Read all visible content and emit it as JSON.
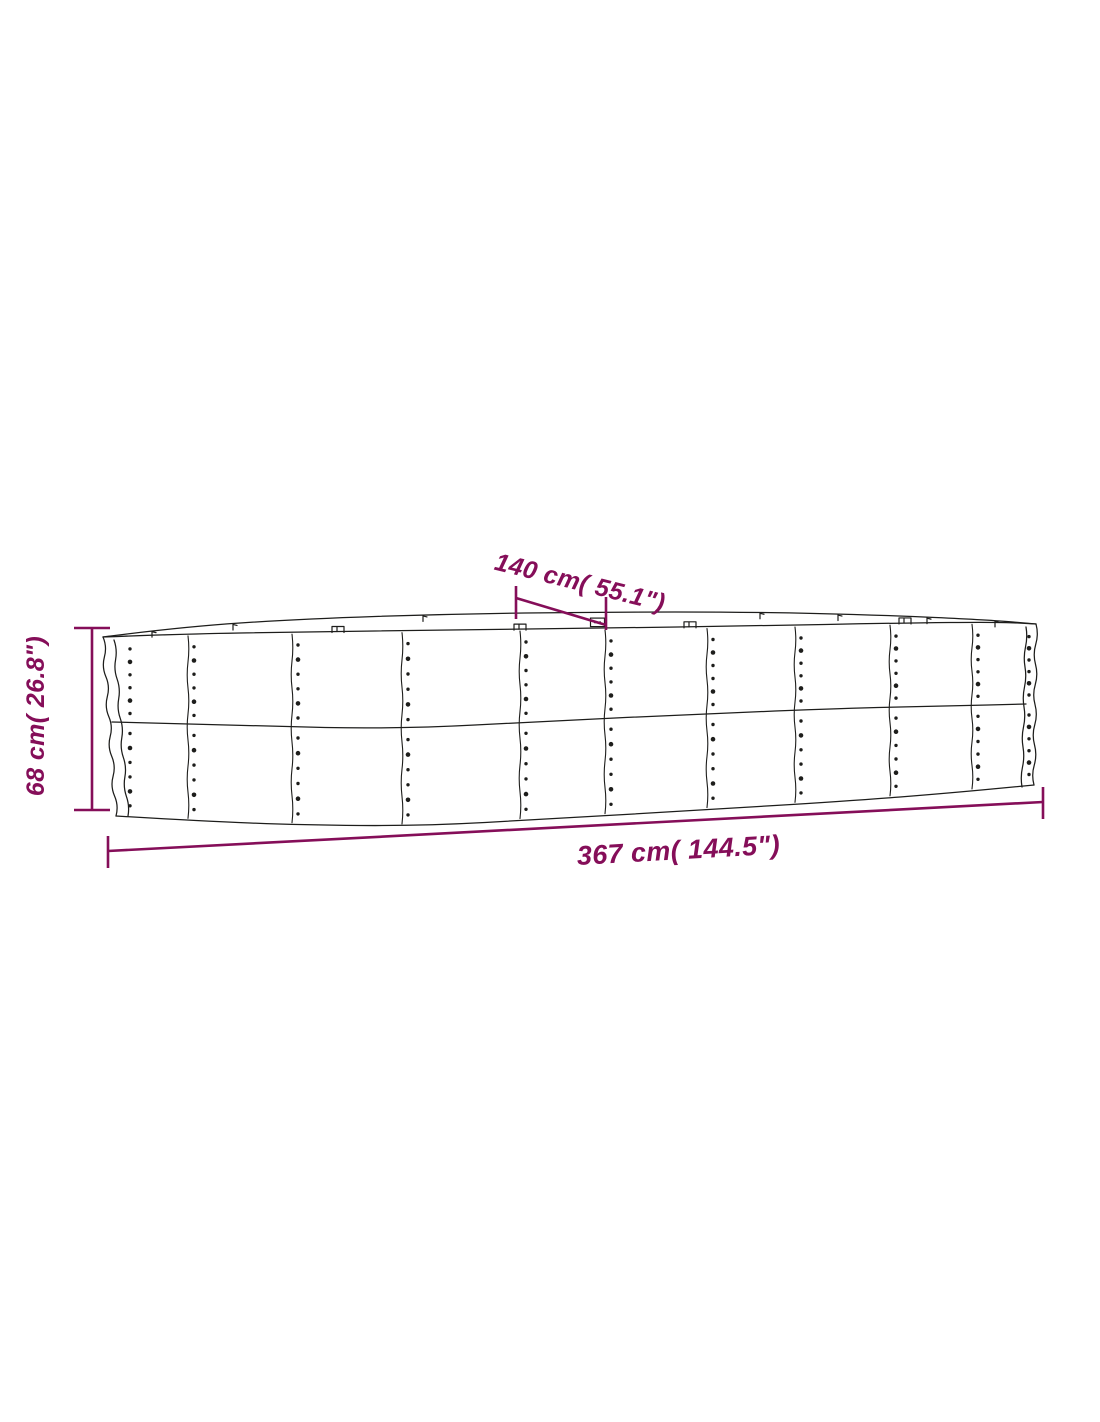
{
  "page": {
    "background": "#ffffff"
  },
  "diagram": {
    "name": "raised-garden-bed-dimension-drawing",
    "outline_color": "#1d1d1b",
    "accent_color": "#850e59",
    "labels": {
      "width_top": "140 cm( 55.1\")",
      "height_left": "68 cm( 26.8\")",
      "length_bottom": "367 cm( 144.5\")"
    }
  }
}
